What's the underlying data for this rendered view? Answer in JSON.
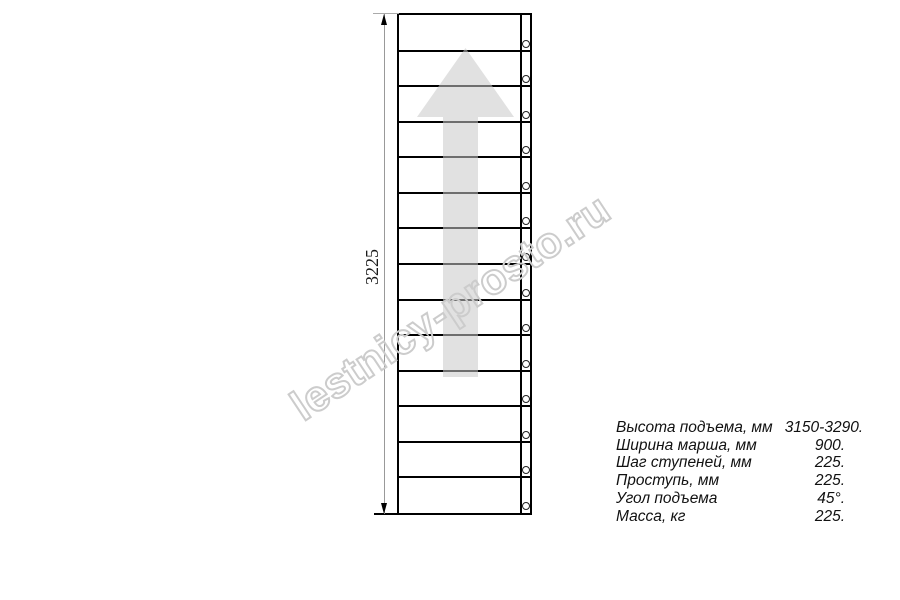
{
  "diagram": {
    "type": "staircase-top-view-plan",
    "dimension_label": "3225",
    "step_count": 14,
    "arrow_direction": "up",
    "colors": {
      "outline": "#000000",
      "dimension_line": "#999999",
      "arrow_fill": "#dddddd",
      "watermark": "#cccccc"
    }
  },
  "watermark": {
    "text": "lestnicy-prosto.ru"
  },
  "specs": {
    "rows": [
      {
        "label": "Высота подъема, мм",
        "value": "3150-3290."
      },
      {
        "label": "Ширина марша, мм",
        "value": "900."
      },
      {
        "label": "Шаг ступеней, мм",
        "value": "225."
      },
      {
        "label": "Проступь, мм",
        "value": "225."
      },
      {
        "label": "Угол подъема",
        "value": "45°."
      },
      {
        "label": "Масса, кг",
        "value": "225."
      }
    ]
  }
}
